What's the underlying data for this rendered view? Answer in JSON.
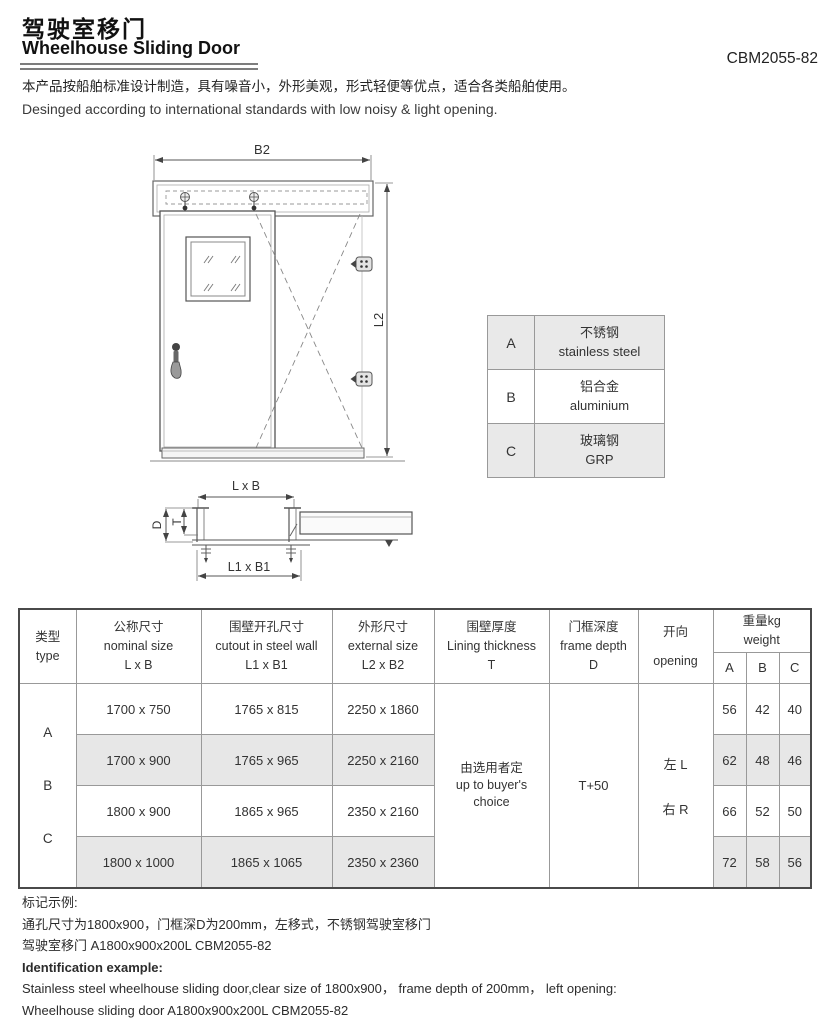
{
  "header": {
    "title_zh": "驾驶室移门",
    "title_en": "Wheelhouse Sliding Door",
    "model": "CBM2055-82",
    "desc_zh": "本产品按船舶标准设计制造，具有噪音小，外形美观，形式轻便等优点，适合各类船舶使用。",
    "desc_en": "Desinged according to international standards with low noisy & light opening."
  },
  "drawing": {
    "labels": {
      "b2": "B2",
      "l2": "L2",
      "lxb": "L x B",
      "l1xb1": "L1 x B1",
      "d": "D",
      "t": "T"
    }
  },
  "materials": {
    "rows": [
      {
        "code": "A",
        "zh": "不锈钢",
        "en": "stainless steel"
      },
      {
        "code": "B",
        "zh": "铝合金",
        "en": "aluminium"
      },
      {
        "code": "C",
        "zh": "玻璃钢",
        "en": "GRP"
      }
    ]
  },
  "spec_table": {
    "headers": {
      "type_zh": "类型",
      "type_en": "type",
      "nominal_zh": "公称尺寸",
      "nominal_en": "nominal size",
      "nominal_sym": "L x B",
      "cutout_zh": "围壁开孔尺寸",
      "cutout_en": "cutout in steel wall",
      "cutout_sym": "L1 x B1",
      "external_zh": "外形尺寸",
      "external_en": "external size",
      "external_sym": "L2 x B2",
      "lining_zh": "围壁厚度",
      "lining_en": "Lining thickness",
      "lining_sym": "T",
      "frame_zh": "门框深度",
      "frame_en": "frame depth",
      "frame_sym": "D",
      "opening_zh": "开向",
      "opening_en": "opening",
      "weight_zh": "重量kg",
      "weight_en": "weight",
      "weight_a": "A",
      "weight_b": "B",
      "weight_c": "C"
    },
    "types": {
      "a": "A",
      "b": "B",
      "c": "C"
    },
    "rows": [
      {
        "nominal": "1700 x 750",
        "cutout": "1765 x 815",
        "external": "2250 x 1860",
        "a": "56",
        "b": "42",
        "c": "40"
      },
      {
        "nominal": "1700 x 900",
        "cutout": "1765 x 965",
        "external": "2250 x 2160",
        "a": "62",
        "b": "48",
        "c": "46"
      },
      {
        "nominal": "1800 x 900",
        "cutout": "1865 x 965",
        "external": "2350 x 2160",
        "a": "66",
        "b": "52",
        "c": "50"
      },
      {
        "nominal": "1800 x 1000",
        "cutout": "1865 x 1065",
        "external": "2350 x 2360",
        "a": "72",
        "b": "58",
        "c": "56"
      }
    ],
    "merged": {
      "lining_zh": "由选用者定",
      "lining_en1": "up to buyer's",
      "lining_en2": "choice",
      "frame_value": "T+50",
      "opening_left": "左 L",
      "opening_right": "右 R"
    }
  },
  "footer": {
    "example_zh_title": "标记示例:",
    "example_zh_line1": "通孔尺寸为1800x900，门框深D为200mm，左移式，不锈钢驾驶室移门",
    "example_zh_line2": "驾驶室移门 A1800x900x200L CBM2055-82",
    "example_en_title": "Identification example:",
    "example_en_line1": "Stainless steel wheelhouse sliding door,clear size of 1800x900， frame depth of 200mm， left opening:",
    "example_en_line2": "Wheelhouse sliding door A1800x900x200L CBM2055-82"
  }
}
